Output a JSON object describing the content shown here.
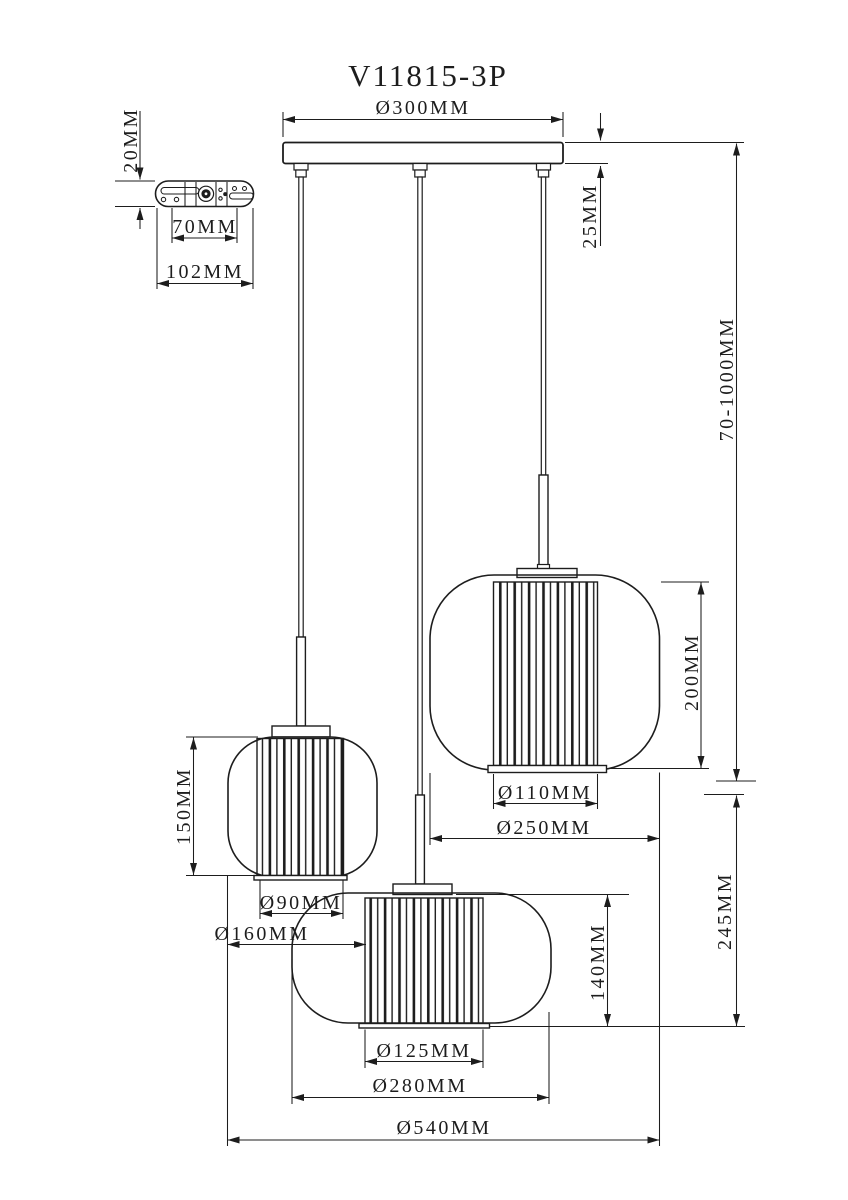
{
  "drawing": {
    "title": "V11815-3P",
    "line_color": "#1d1d1d",
    "background_color": "#ffffff"
  },
  "mount_bracket": {
    "thickness": "20MM",
    "hole_spacing": "70MM",
    "length": "102MM"
  },
  "canopy": {
    "diameter": "Ø300MM",
    "height": "25MM"
  },
  "suspension": {
    "cord_length_range": "70-1000MM",
    "lower_section_height": "245MM"
  },
  "shade_small": {
    "height": "150MM",
    "inner_diameter": "Ø90MM",
    "outer_diameter": "Ø160MM"
  },
  "shade_large": {
    "height": "200MM",
    "inner_diameter": "Ø110MM",
    "outer_diameter": "Ø250MM"
  },
  "shade_medium": {
    "height": "140MM",
    "inner_diameter": "Ø125MM",
    "outer_diameter": "Ø280MM"
  },
  "overall": {
    "total_width": "Ø540MM"
  }
}
